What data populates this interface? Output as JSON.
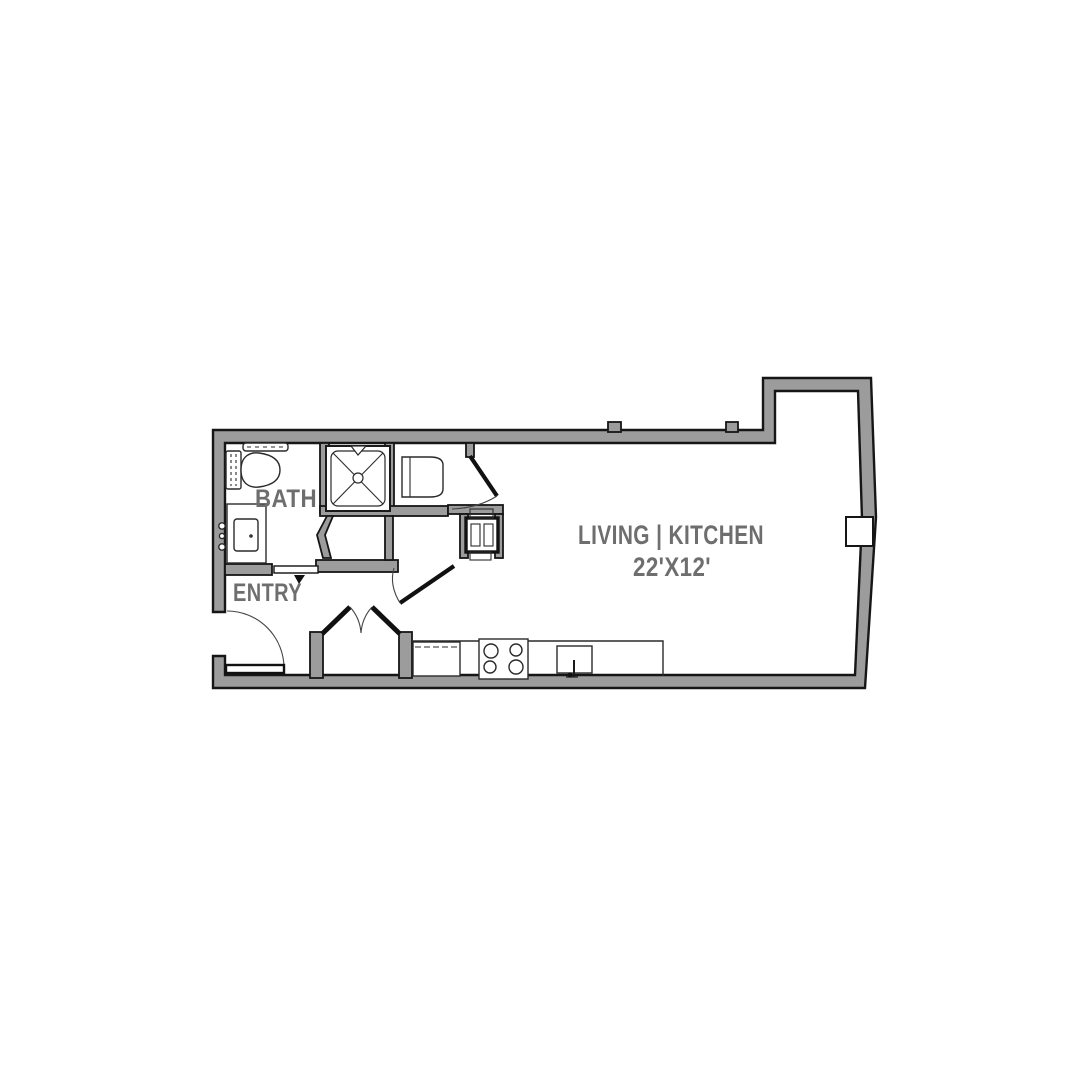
{
  "plan": {
    "labels": {
      "bath": "BATH",
      "entry": "ENTRY",
      "living_kitchen": "LIVING | KITCHEN",
      "living_dims": "22'X12'"
    },
    "colors": {
      "wall_fill": "#9c9c9c",
      "line": "#161616",
      "label_text": "#6e6e6e",
      "background": "#ffffff"
    }
  }
}
